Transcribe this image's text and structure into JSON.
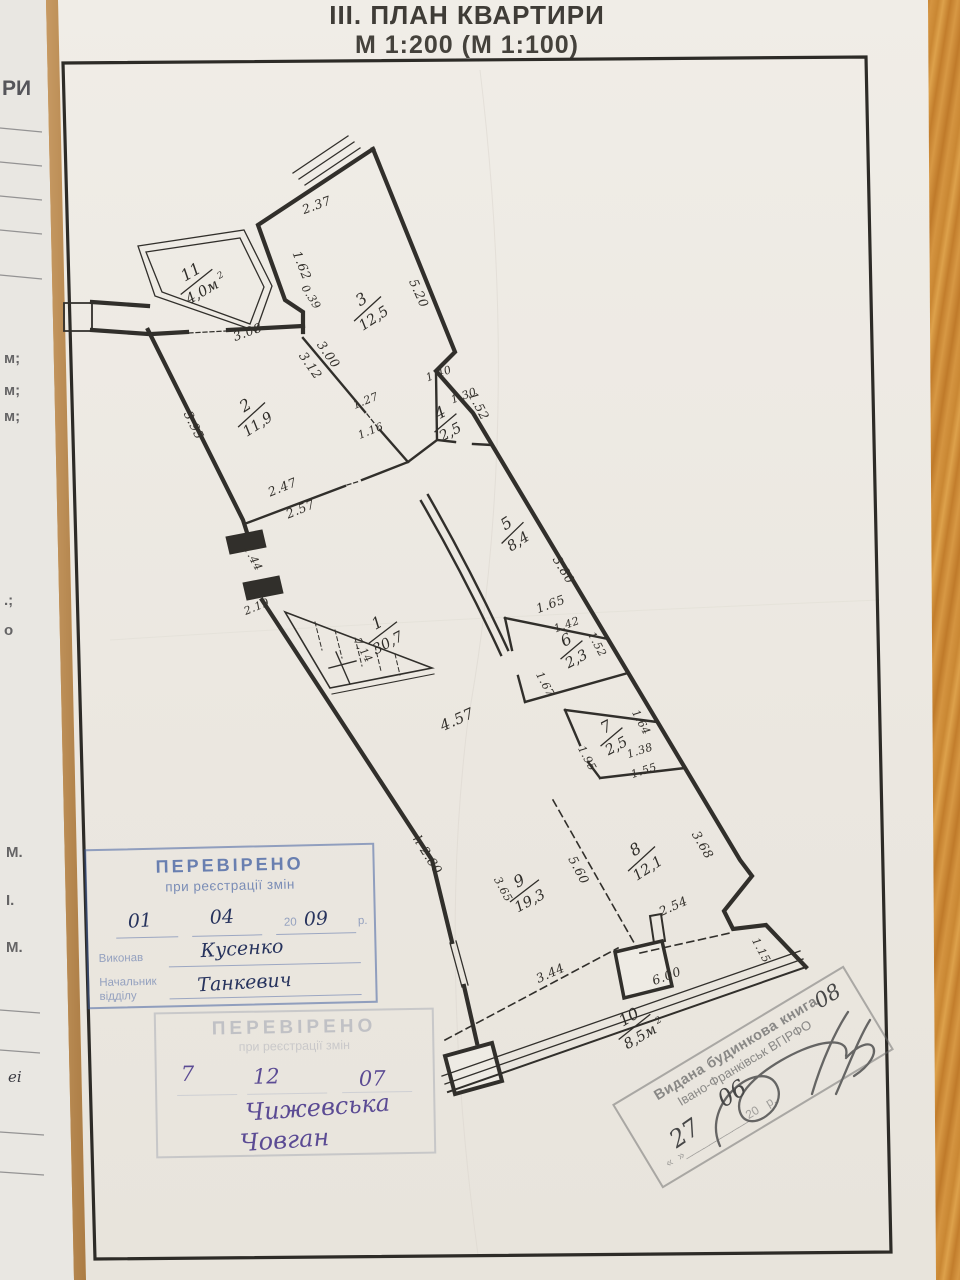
{
  "page": {
    "title_line1": "ІІІ. ПЛАН КВАРТИРИ",
    "title_line2": "М 1:200 (М 1:100)"
  },
  "side_fragments": [
    "РИ",
    "м;",
    "м;",
    "м;",
    ".;",
    "о",
    "М.",
    "І.",
    "М.",
    "еі"
  ],
  "plan": {
    "height_note": "h-2.80",
    "rooms": [
      {
        "num": "1",
        "area": "30,7"
      },
      {
        "num": "2",
        "area": "11,9"
      },
      {
        "num": "3",
        "area": "12,5"
      },
      {
        "num": "4",
        "area": "2,5"
      },
      {
        "num": "5",
        "area": "8,4"
      },
      {
        "num": "6",
        "area": "2,3"
      },
      {
        "num": "7",
        "area": "2,5"
      },
      {
        "num": "8",
        "area": "12,1"
      },
      {
        "num": "9",
        "area": "19,3"
      },
      {
        "num": "10",
        "area": "8,5м",
        "sup": "2"
      },
      {
        "num": "11",
        "area": "4,0м",
        "sup": "2"
      }
    ],
    "dims": [
      "2.37",
      "1.62",
      "5.20",
      "0.39",
      "3.08",
      "3.00",
      "3.12",
      "3.95",
      "1.27",
      "1.16",
      "1.40",
      "1.30",
      "1.52",
      "2.47",
      "2.57",
      "1.44",
      "2.19",
      "3.80",
      "1.65",
      "1.42",
      "1.52",
      "1.67",
      "4.57",
      "1.64",
      "1.38",
      "1.95",
      "1.55",
      "3.68",
      "5.60",
      "3.65",
      "2.54",
      "3.44",
      "6.00",
      "1.15",
      "7,14"
    ]
  },
  "stamps": {
    "verified1": {
      "title": "ПЕРЕВІРЕНО",
      "subtitle": "при реєстрації змін",
      "day": "01",
      "month": "04",
      "year_printed": "20",
      "year_hw": "09",
      "year_suffix": "р.",
      "executor_label": "Виконав",
      "executor_name": "Кусенко",
      "chief_label_1": "Начальник",
      "chief_label_2": "відділу",
      "chief_name": "Танкевич"
    },
    "verified2": {
      "title": "ПЕРЕВІРЕНО",
      "subtitle": "при реєстрації змін",
      "day": "7",
      "month": "12",
      "year": "07",
      "name_1": "Чижевська",
      "name_2": "Човган"
    },
    "house_book": {
      "line1": "Видана будинкова книга",
      "line2": "Івано-Франківськ ВГІРФО",
      "day": "27",
      "month": "06",
      "year_printed": "20",
      "year_hw": "08",
      "year_suffix": "р."
    }
  }
}
